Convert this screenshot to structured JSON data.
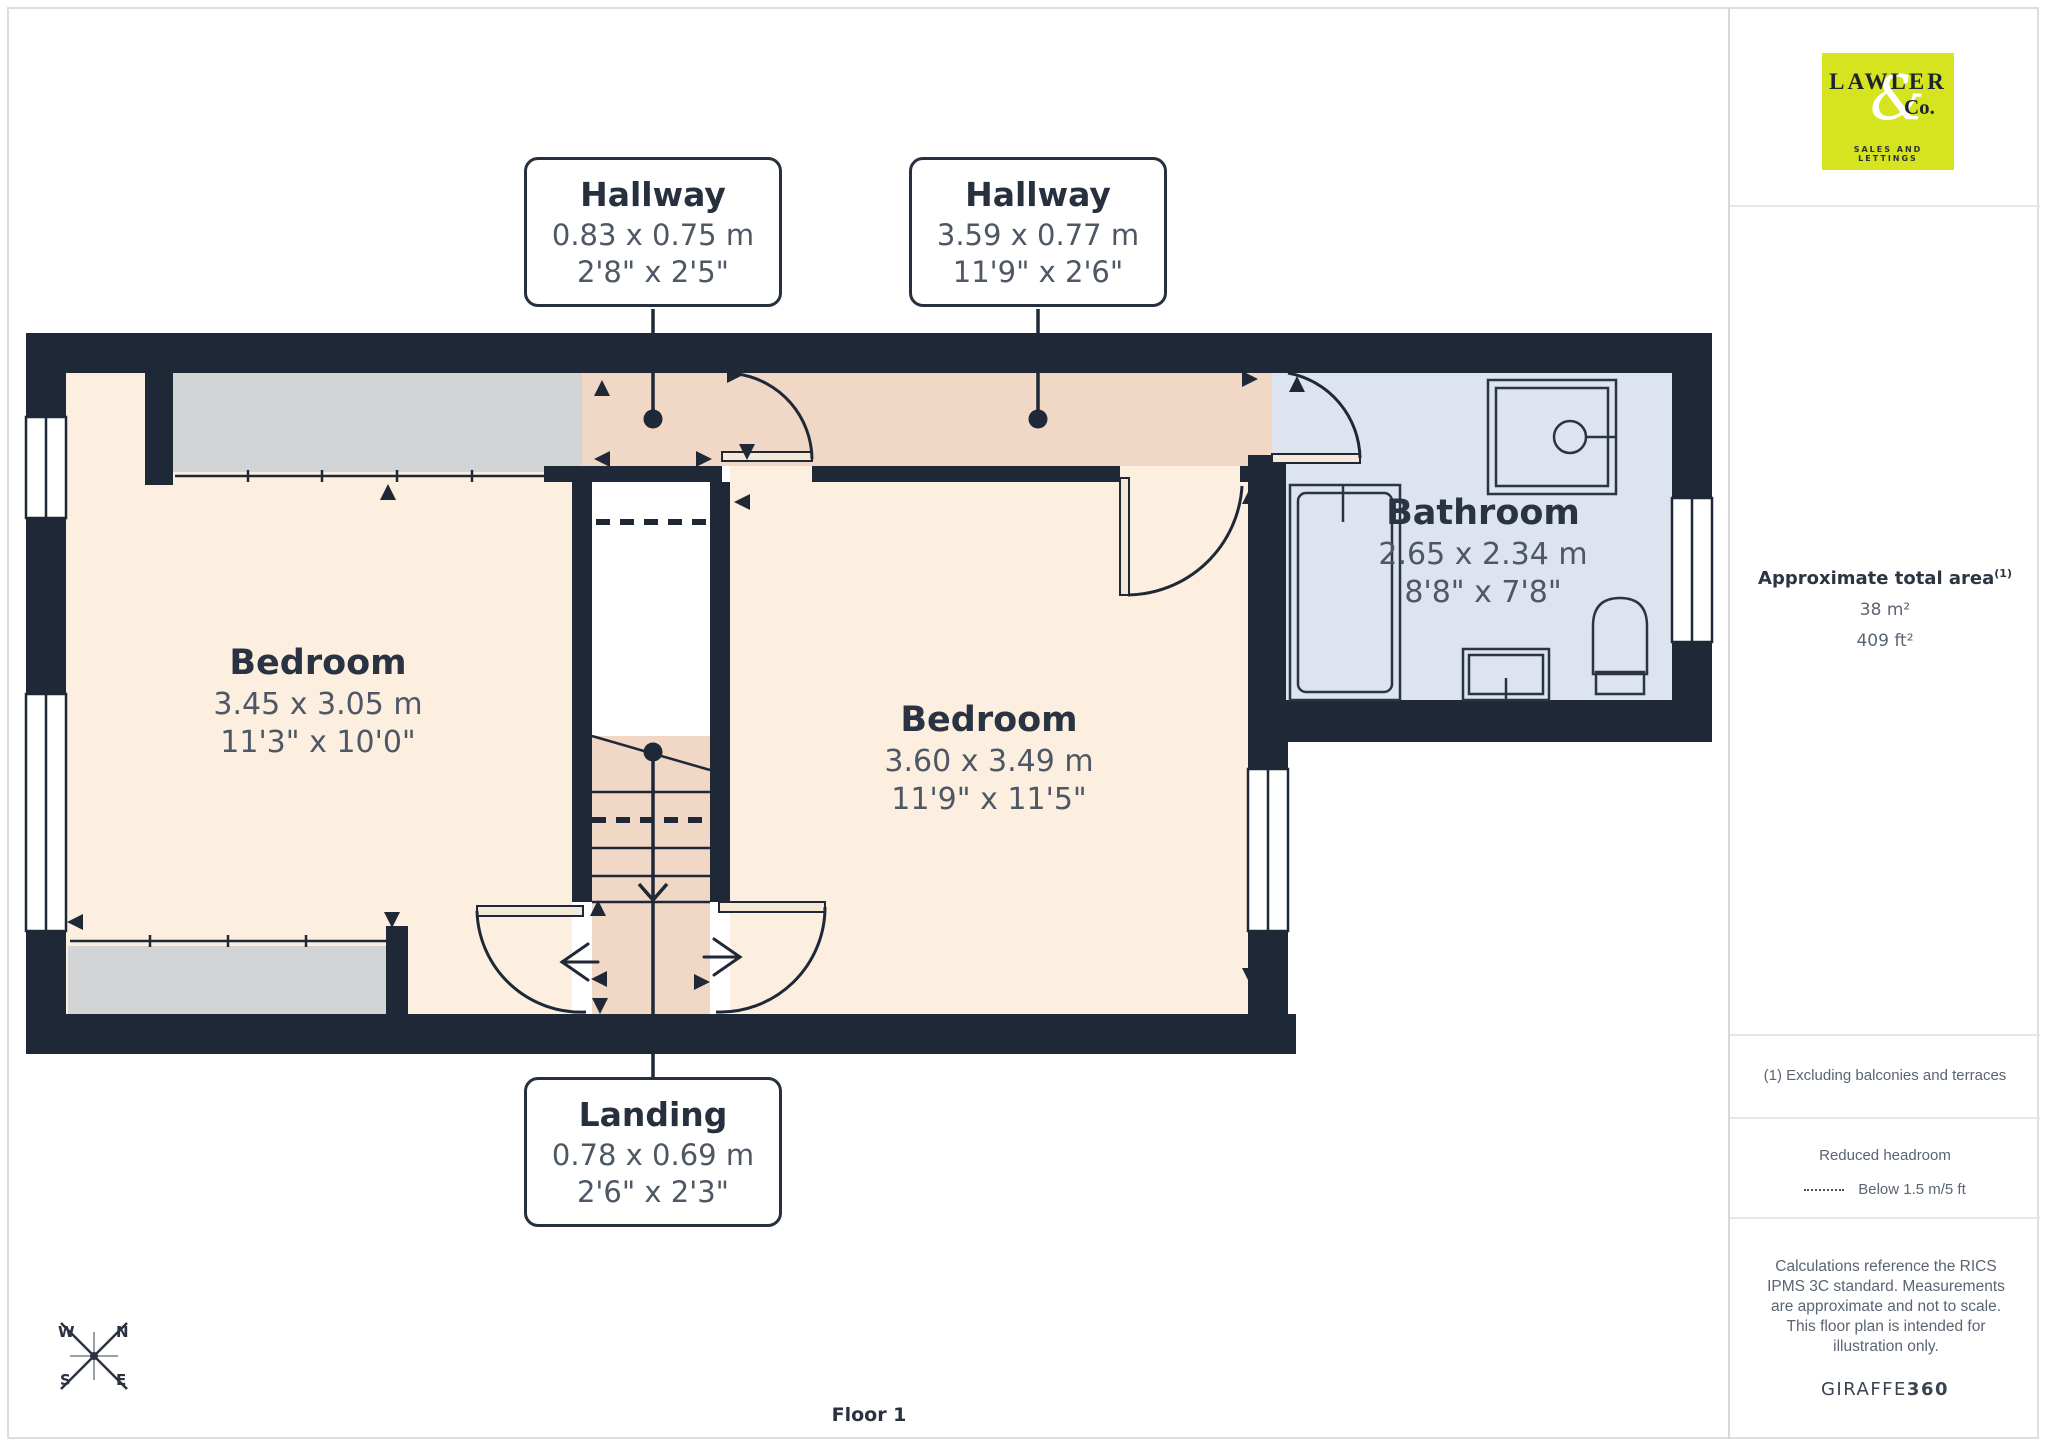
{
  "branding": {
    "logo_name": "LAWLER",
    "logo_ampersand": "&",
    "logo_co": "Co.",
    "logo_tagline": "SALES AND LETTINGS"
  },
  "sidebar": {
    "area_title": "Approximate total area",
    "area_superscript": "(1)",
    "area_metric": "38 m²",
    "area_imperial": "409 ft²",
    "footnote": "(1) Excluding balconies and terraces",
    "legend_title": "Reduced headroom",
    "legend_item": "Below 1.5 m/5 ft",
    "disclaimer": "Calculations reference the RICS IPMS 3C standard. Measurements are approximate and not to scale. This floor plan is intended for illustration only.",
    "brand_name": "GIRAFFE",
    "brand_suffix": "360"
  },
  "rooms": [
    {
      "id": "bedroom-1",
      "name": "Bedroom",
      "metric": "3.45 x 3.05 m",
      "imperial": "11'3\" x 10'0\""
    },
    {
      "id": "bedroom-2",
      "name": "Bedroom",
      "metric": "3.60 x 3.49 m",
      "imperial": "11'9\" x 11'5\""
    },
    {
      "id": "bathroom",
      "name": "Bathroom",
      "metric": "2.65 x 2.34 m",
      "imperial": "8'8\" x 7'8\""
    }
  ],
  "callouts": [
    {
      "id": "hallway-1",
      "name": "Hallway",
      "metric": "0.83 x 0.75 m",
      "imperial": "2'8\" x 2'5\""
    },
    {
      "id": "hallway-2",
      "name": "Hallway",
      "metric": "3.59 x 0.77 m",
      "imperial": "11'9\" x 2'6\""
    },
    {
      "id": "landing",
      "name": "Landing",
      "metric": "0.78 x 0.69 m",
      "imperial": "2'6\" x 2'3\""
    }
  ],
  "compass": {
    "w": "W",
    "n": "N",
    "s": "S",
    "e": "E"
  },
  "floor_label": "Floor 1",
  "colors": {
    "wall": "#1e2836",
    "bedroom_fill": "#fcefdf",
    "hallway_fill": "#f0d7c6",
    "bathroom_fill": "#dde3ef",
    "wardrobe_fill": "#d2d4d6",
    "logo_background": "#d5e41e",
    "label_dark": "#2a3342",
    "label_gray": "#4e5865",
    "sidebar_text": "#5a6472"
  }
}
